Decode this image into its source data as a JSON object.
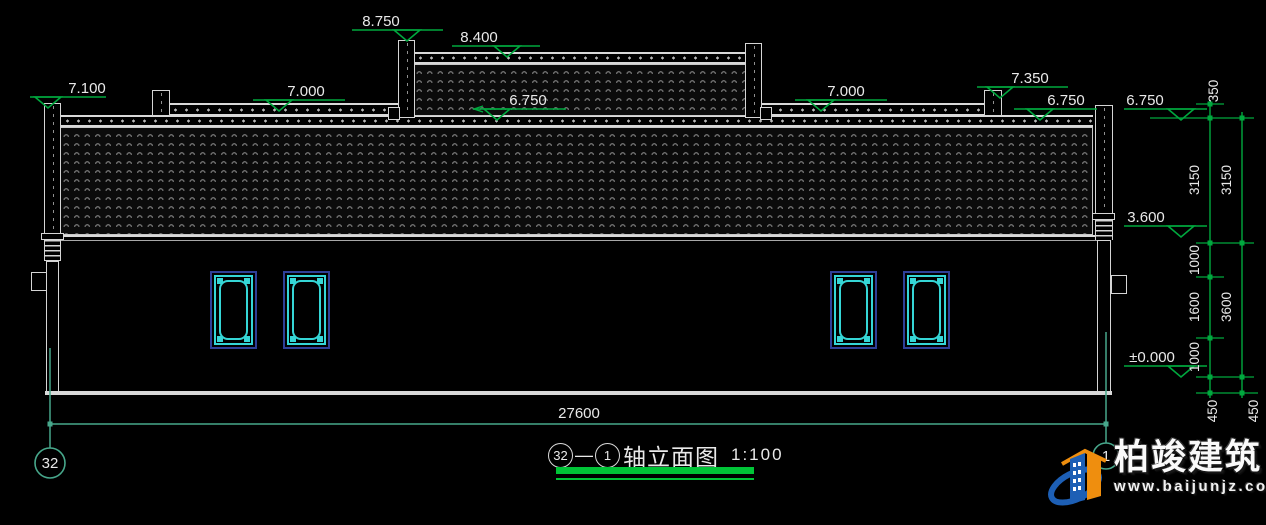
{
  "colors": {
    "background": "#000000",
    "line_white": "#d9d9d9",
    "annotation_green": "#00a83e",
    "axis_teal": "#47a78b",
    "title_underline_green": "#00c437",
    "window_cyan": "#35d6d6",
    "window_navy": "#2e3f96",
    "text_white": "#e9e9e9",
    "logo_blue": "#1d5fb5",
    "logo_orange": "#ef8e0e"
  },
  "title_block": {
    "axis_start": "32",
    "dash": "—",
    "axis_end": "1",
    "title": "轴立面图",
    "scale": "1:100"
  },
  "bottom_dimension": {
    "label": "27600",
    "y": 424,
    "x1": 50,
    "x2": 1106,
    "tx": 579
  },
  "elevation_markers": [
    {
      "label": "7.100",
      "y": 97,
      "x1": 30,
      "x2": 106,
      "tri": 48,
      "tx": 87
    },
    {
      "label": "8.750",
      "y": 30,
      "x1": 352,
      "x2": 443,
      "tri": 407,
      "tx": 381
    },
    {
      "label": "8.400",
      "y": 46,
      "x1": 452,
      "x2": 540,
      "tri": 507,
      "tx": 479
    },
    {
      "label": "7.000",
      "y": 100,
      "x1": 253,
      "x2": 345,
      "tri": 279,
      "tx": 306
    },
    {
      "label": "6.750",
      "y": 109,
      "x1": 474,
      "x2": 566,
      "tri": 497,
      "tx": 528,
      "arrow_left": true
    },
    {
      "label": "7.000",
      "y": 100,
      "x1": 795,
      "x2": 887,
      "tri": 821,
      "tx": 846
    },
    {
      "label": "7.350",
      "y": 87,
      "x1": 977,
      "x2": 1068,
      "tri": 1000,
      "tx": 1030
    },
    {
      "label": "6.750",
      "y": 109,
      "x1": 1014,
      "x2": 1097,
      "tri": 1040,
      "tx": 1066
    },
    {
      "label": "6.750",
      "y": 109,
      "x1": 1124,
      "x2": 1207,
      "tri": 1181,
      "tx": 1145
    },
    {
      "label": "3.600",
      "y": 226,
      "x1": 1124,
      "x2": 1207,
      "tri": 1181,
      "tx": 1146
    },
    {
      "label": "±0.000",
      "y": 366,
      "x1": 1124,
      "x2": 1207,
      "tri": 1181,
      "tx": 1152
    }
  ],
  "dimension_chains": [
    {
      "x": 1210,
      "y_top": 100,
      "y_bot": 398,
      "ticks": [
        104,
        118,
        243,
        277,
        338,
        377,
        393
      ],
      "labels": [
        {
          "text": "350",
          "cx": 1218,
          "cy": 91
        },
        {
          "text": "3150",
          "cx": 1199,
          "cy": 180
        },
        {
          "text": "1000",
          "cx": 1199,
          "cy": 260
        },
        {
          "text": "1600",
          "cx": 1199,
          "cy": 307
        },
        {
          "text": "1000",
          "cx": 1199,
          "cy": 357
        },
        {
          "text": "450",
          "cx": 1217,
          "cy": 411
        }
      ]
    },
    {
      "x": 1242,
      "y_top": 112,
      "y_bot": 398,
      "ticks": [
        118,
        243,
        377,
        393
      ],
      "labels": [
        {
          "text": "3150",
          "cx": 1231,
          "cy": 180
        },
        {
          "text": "3600",
          "cx": 1231,
          "cy": 307
        },
        {
          "text": "450",
          "cx": 1258,
          "cy": 411
        }
      ]
    }
  ],
  "chain_connectors": [
    {
      "y": 104,
      "x1": 1196,
      "x2": 1224
    },
    {
      "y": 118,
      "x1": 1150,
      "x2": 1254
    },
    {
      "y": 243,
      "x1": 1196,
      "x2": 1254
    },
    {
      "y": 277,
      "x1": 1196,
      "x2": 1224
    },
    {
      "y": 338,
      "x1": 1196,
      "x2": 1224
    },
    {
      "y": 377,
      "x1": 1196,
      "x2": 1254
    },
    {
      "y": 393,
      "x1": 1196,
      "x2": 1258
    }
  ],
  "axis_lines": [
    {
      "x": 50,
      "y1": 348,
      "y2": 448
    },
    {
      "x": 1106,
      "y1": 332,
      "y2": 443
    }
  ],
  "bubbles": [
    {
      "label": "32",
      "cx": 50,
      "cy": 463,
      "r": 15
    },
    {
      "label": "1",
      "cx": 1106,
      "cy": 456,
      "r": 13
    }
  ],
  "windows": {
    "xs": [
      210,
      283,
      830,
      903
    ],
    "y": 271,
    "w": 47,
    "h": 78
  },
  "logo": {
    "brand": "柏竣建筑",
    "url": "www.baijunjz.com"
  }
}
